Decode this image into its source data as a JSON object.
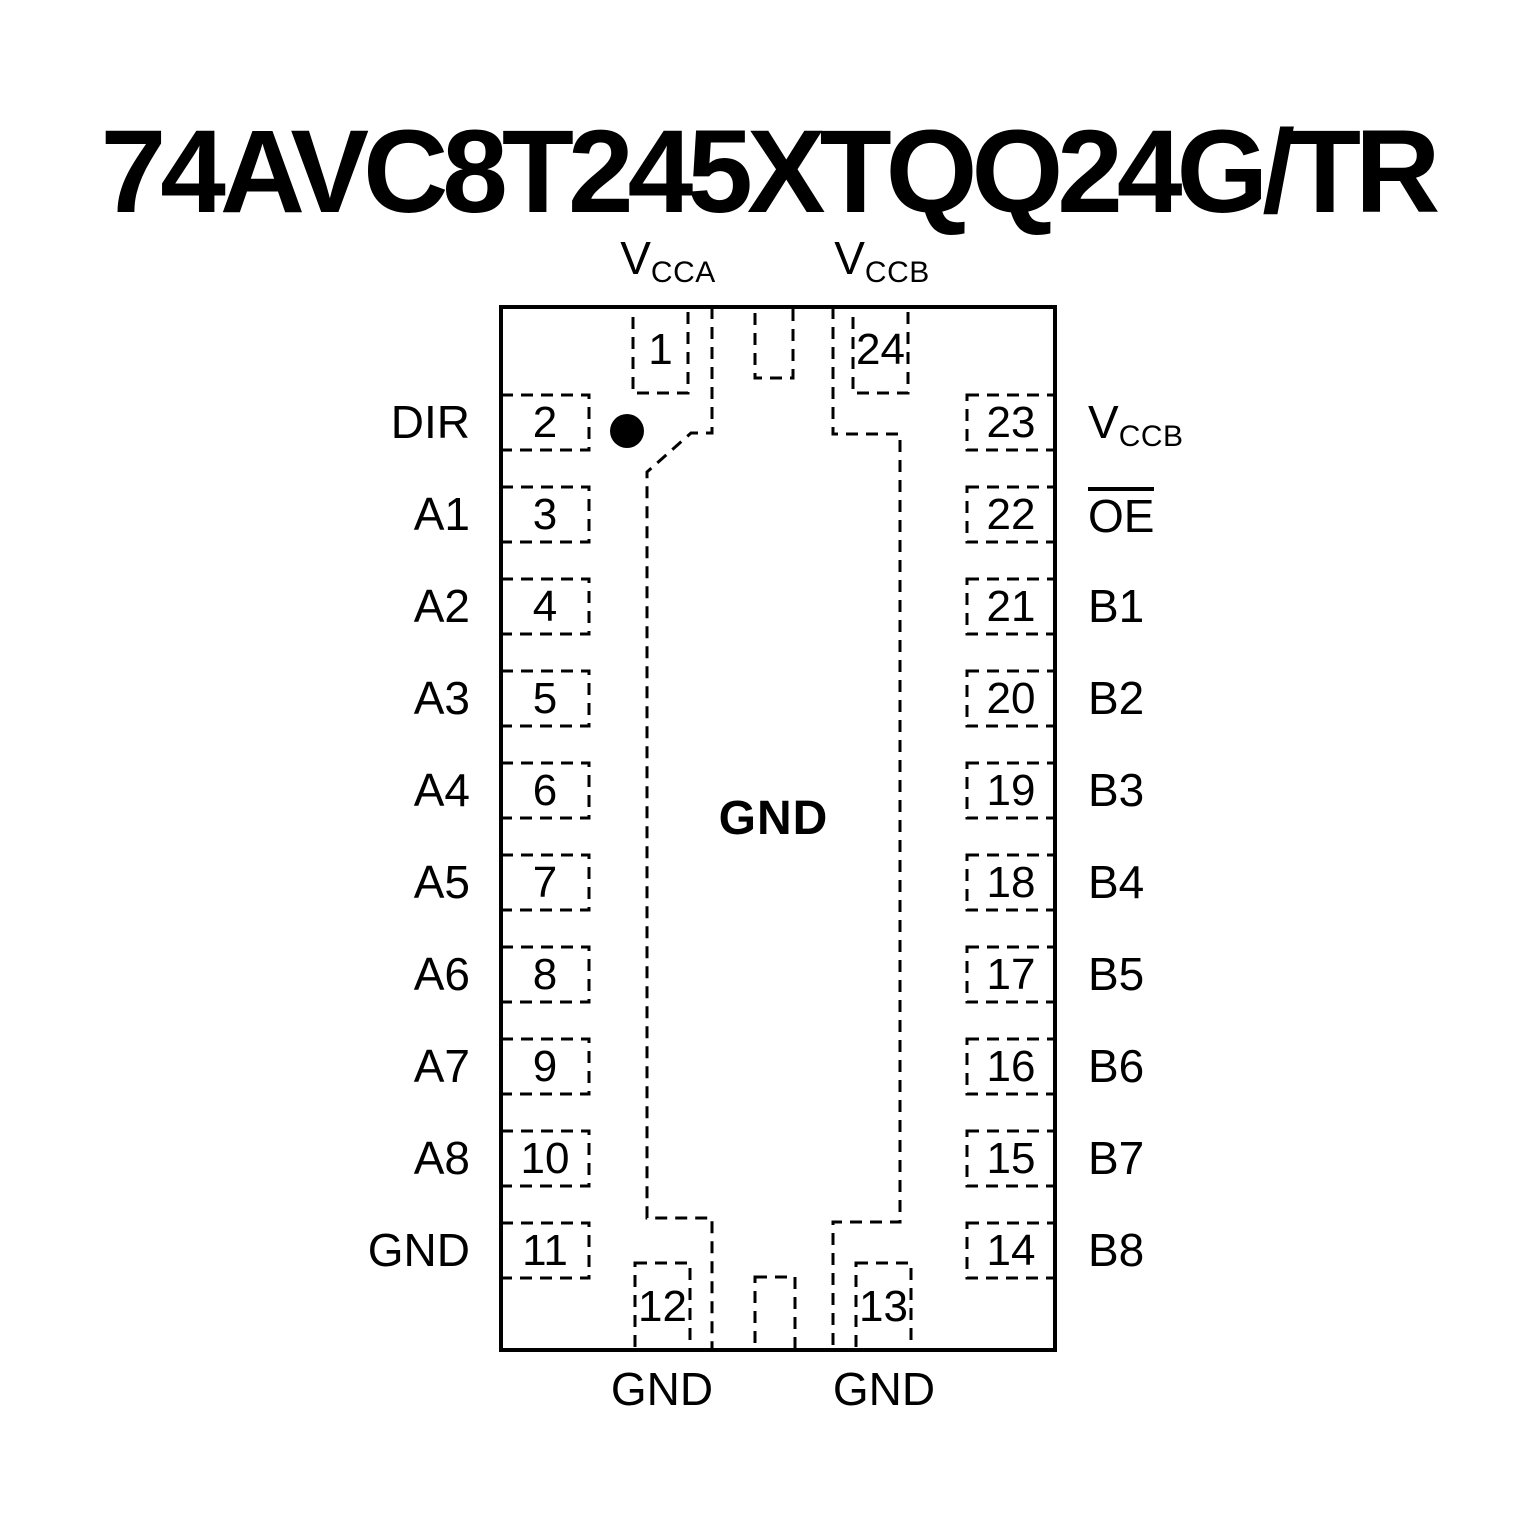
{
  "title": "74AVC8T245XTQQ24G/TR",
  "colors": {
    "ink": "#000000",
    "background": "#ffffff"
  },
  "chip": {
    "package": "QFN-24 top view",
    "center_pad_label": "GND",
    "pin1_indicator": "filled-dot",
    "top_pins": [
      {
        "number": "1",
        "label": "VCCA",
        "label_base": "V",
        "label_sub": "CCA"
      },
      {
        "number": "24",
        "label": "VCCB",
        "label_base": "V",
        "label_sub": "CCB"
      }
    ],
    "left_pins": [
      {
        "number": "2",
        "label": "DIR"
      },
      {
        "number": "3",
        "label": "A1"
      },
      {
        "number": "4",
        "label": "A2"
      },
      {
        "number": "5",
        "label": "A3"
      },
      {
        "number": "6",
        "label": "A4"
      },
      {
        "number": "7",
        "label": "A5"
      },
      {
        "number": "8",
        "label": "A6"
      },
      {
        "number": "9",
        "label": "A7"
      },
      {
        "number": "10",
        "label": "A8"
      },
      {
        "number": "11",
        "label": "GND"
      }
    ],
    "right_pins": [
      {
        "number": "23",
        "label": "VCCB",
        "label_base": "V",
        "label_sub": "CCB"
      },
      {
        "number": "22",
        "label": "OE",
        "active_low": true
      },
      {
        "number": "21",
        "label": "B1"
      },
      {
        "number": "20",
        "label": "B2"
      },
      {
        "number": "19",
        "label": "B3"
      },
      {
        "number": "18",
        "label": "B4"
      },
      {
        "number": "17",
        "label": "B5"
      },
      {
        "number": "16",
        "label": "B6"
      },
      {
        "number": "15",
        "label": "B7"
      },
      {
        "number": "14",
        "label": "B8"
      }
    ],
    "bottom_pins": [
      {
        "number": "12",
        "label": "GND"
      },
      {
        "number": "13",
        "label": "GND"
      }
    ]
  }
}
